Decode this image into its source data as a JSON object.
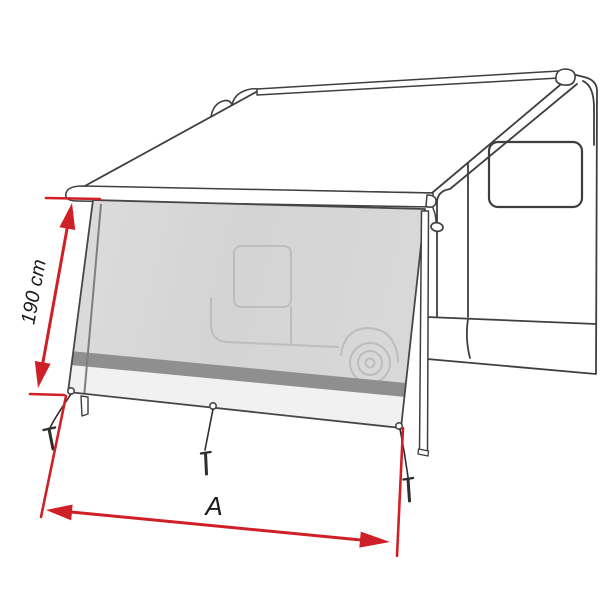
{
  "diagram": {
    "height_label": "190 cm",
    "width_label": "A",
    "colors": {
      "dimension_red": "#cf2027",
      "outline_dark": "#3f3f3f",
      "silhouette_gray": "#bdbdbd",
      "band_gray": "#8f8f8f",
      "hem_light": "#f1f1f1",
      "guy_line_dark": "#2e2e2e"
    }
  }
}
